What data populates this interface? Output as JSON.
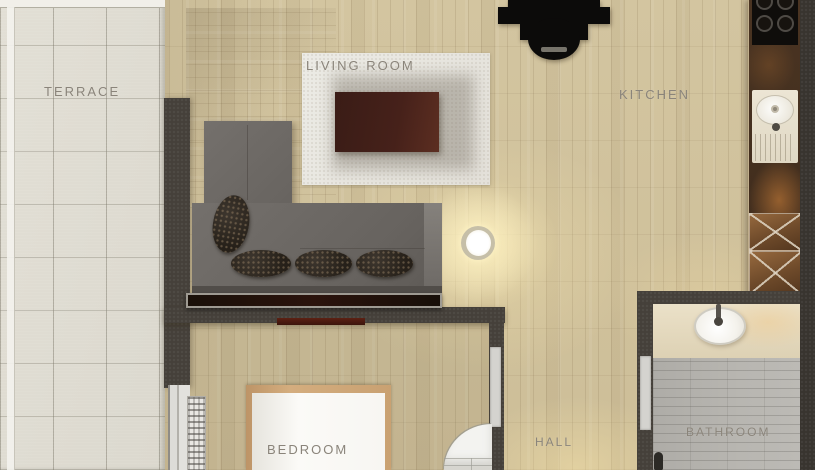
{
  "rooms": {
    "terrace": {
      "label": "TERRACE"
    },
    "living_room": {
      "label": "LIVING ROOM"
    },
    "kitchen": {
      "label": "KITCHEN"
    },
    "hall": {
      "label": "HALL"
    },
    "bedroom": {
      "label": "BEDROOM"
    },
    "bathroom": {
      "label": "BATHROOM"
    }
  },
  "furniture": {
    "living_room": [
      "sectional-sofa",
      "throw-pillows",
      "area-rug",
      "coffee-table",
      "tv-console",
      "armchair",
      "ceiling-light"
    ],
    "kitchen": [
      "cooktop",
      "sink",
      "counter",
      "marked-cabinets"
    ],
    "bedroom": [
      "double-bed",
      "radiator",
      "wall-tv",
      "window"
    ],
    "bathroom": [
      "washbasin",
      "counter",
      "tiled-floor"
    ],
    "hall": [
      "door-swing"
    ]
  },
  "colors": {
    "wood_floor": "#cfc19c",
    "terrace_tile": "#dfdcd2",
    "wall": "#45403a",
    "rug": "#e9e7e1",
    "sofa": "#6c6864",
    "coffee_table": "#46211a",
    "kitchen_counter": "#46311f",
    "bathroom_floor": "#b4b2ad",
    "bed_frame": "#c9a172",
    "label_text": "#8a847a"
  }
}
